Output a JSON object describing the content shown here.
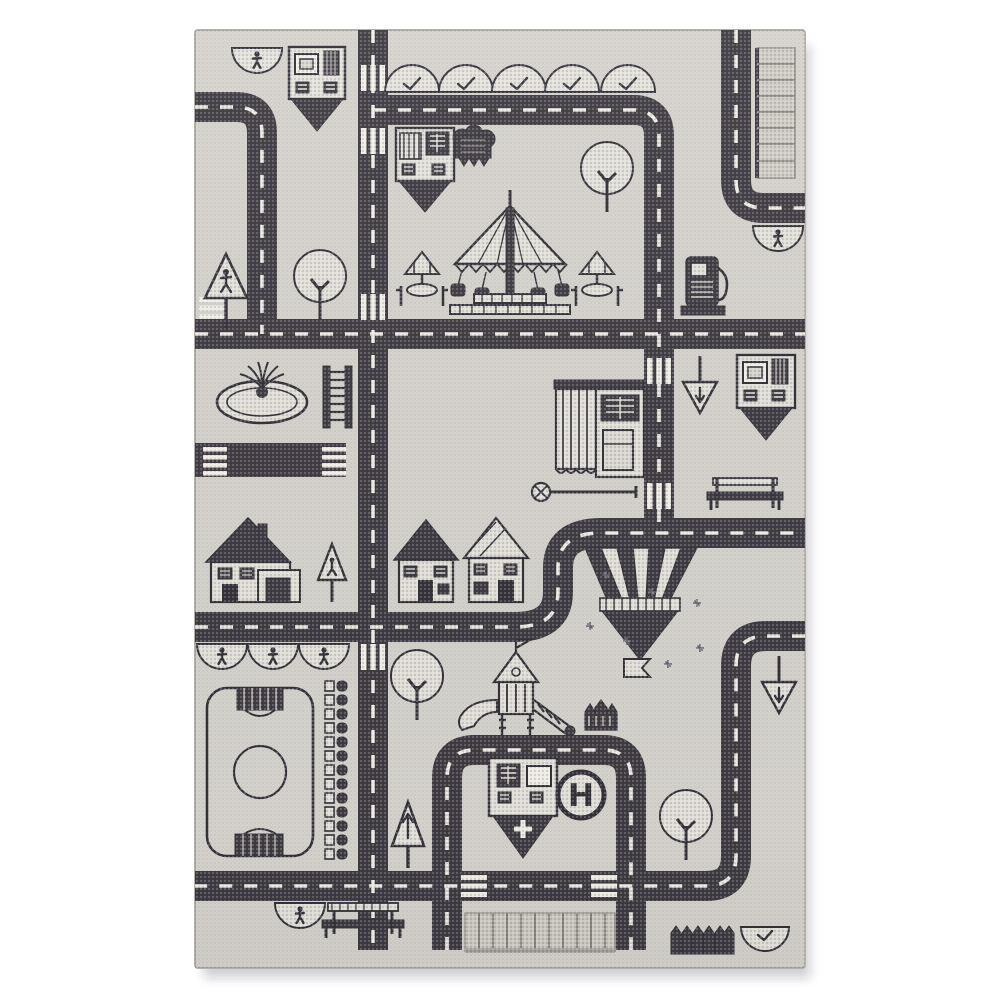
{
  "scene": {
    "description": "Product photo of a rectangular children's play rug woven in black and cream, depicting a city road map with streets, houses, a park, a playground, a sports field and a hospital helipad, on a plain white background",
    "background_color": "#ffffff"
  },
  "colors": {
    "rug_field": "#d8d5cf",
    "road": "#403c43",
    "road_marking": "#efede6",
    "outline": "#35323a",
    "object_fill": "#e3e1da",
    "parking_fill": "#cfccc5",
    "shadow": "#c9c6c0"
  },
  "helipad": {
    "label": "H"
  },
  "inventory": {
    "buildings": [
      "pin-building-top-left",
      "pin-building-park",
      "pin-building-east",
      "hospital-pin-building-with-cross",
      "shop-with-striped-awning",
      "house-with-garage",
      "small-house-1",
      "small-house-2"
    ],
    "park_features": [
      "swing-carousel",
      "parasol-table-left",
      "parasol-table-right",
      "fountain",
      "picnic-table-top-view",
      "park-bench-east",
      "picnic-bench-bottom",
      "flowerbed",
      "garden-plot-pin",
      "playground-tower-with-slides",
      "castle-wall",
      "pennant-flag",
      "sparkles"
    ],
    "sports": [
      "sports-field-with-goals",
      "stadium-seat-row"
    ],
    "traffic_features": [
      "gas-pump",
      "helipad-circle",
      "parking-strip-top-right",
      "parking-strip-bottom",
      "zebra-crosswalks",
      "dashed-center-lines",
      "dead-end-street-stub"
    ],
    "signs": [
      "pedestrian-crossing-sign",
      "warning-sign",
      "yield-sign-east",
      "yield-sign-south-east",
      "up-arrow-sign"
    ],
    "nature": {
      "round_trees": 4,
      "dome_bushes_with_check": 6,
      "dome_bushes_with_figure": 6,
      "picket_hedges": 2
    }
  }
}
